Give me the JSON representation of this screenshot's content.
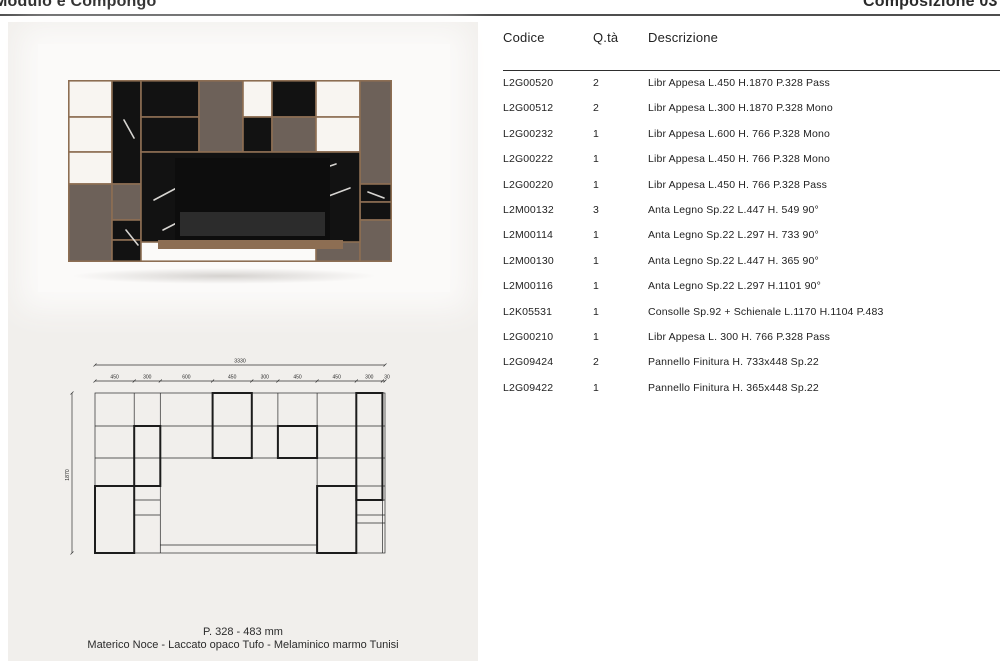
{
  "page": {
    "title_left": "Modulo e Compongo",
    "title_right": "Composizione 03"
  },
  "photo": {
    "caption_line1": "P. 328 - 483 mm",
    "caption_line2": "Materico Noce - Laccato opaco Tufo - Melaminico marmo Tunisi"
  },
  "drawing": {
    "total_width": "3330",
    "height_label": "1870",
    "segments": [
      "450",
      "300",
      "600",
      "450",
      "300",
      "450",
      "450",
      "300",
      "30"
    ]
  },
  "table": {
    "headers": {
      "code": "Codice",
      "qty": "Q.tà",
      "desc": "Descrizione"
    },
    "rows": [
      {
        "code": "L2G00520",
        "qty": "2",
        "desc": "Libr Appesa L.450 H.1870 P.328 Pass"
      },
      {
        "code": "L2G00512",
        "qty": "2",
        "desc": "Libr Appesa L.300 H.1870 P.328 Mono"
      },
      {
        "code": "L2G00232",
        "qty": "1",
        "desc": "Libr Appesa L.600 H. 766 P.328 Mono"
      },
      {
        "code": "L2G00222",
        "qty": "1",
        "desc": "Libr Appesa L.450 H. 766 P.328 Mono"
      },
      {
        "code": "L2G00220",
        "qty": "1",
        "desc": "Libr Appesa L.450 H. 766 P.328 Pass"
      },
      {
        "code": "L2M00132",
        "qty": "3",
        "desc": "Anta Legno Sp.22 L.447 H. 549 90°"
      },
      {
        "code": "L2M00114",
        "qty": "1",
        "desc": "Anta Legno Sp.22 L.297 H. 733 90°"
      },
      {
        "code": "L2M00130",
        "qty": "1",
        "desc": "Anta Legno Sp.22 L.447 H. 365 90°"
      },
      {
        "code": "L2M00116",
        "qty": "1",
        "desc": "Anta Legno Sp.22 L.297 H.1101 90°"
      },
      {
        "code": "L2K05531",
        "qty": "1",
        "desc": "Consolle Sp.92 + Schienale L.1170 H.1104 P.483"
      },
      {
        "code": "L2G00210",
        "qty": "1",
        "desc": "Libr Appesa L. 300 H. 766 P.328 Pass"
      },
      {
        "code": "L2G09424",
        "qty": "2",
        "desc": "Pannello Finitura H. 733x448 Sp.22"
      },
      {
        "code": "L2G09422",
        "qty": "1",
        "desc": "Pannello Finitura H. 365x448 Sp.22"
      }
    ]
  },
  "colors": {
    "panel": "#f1efec",
    "photo-white": "#fbfaf9",
    "rule": "#4f4f4f",
    "text": "#1f1f1f",
    "wood": "#8d6e53",
    "taupe": "#6d6159",
    "marble": "#121212",
    "open-cell": "#f8f5f1"
  }
}
